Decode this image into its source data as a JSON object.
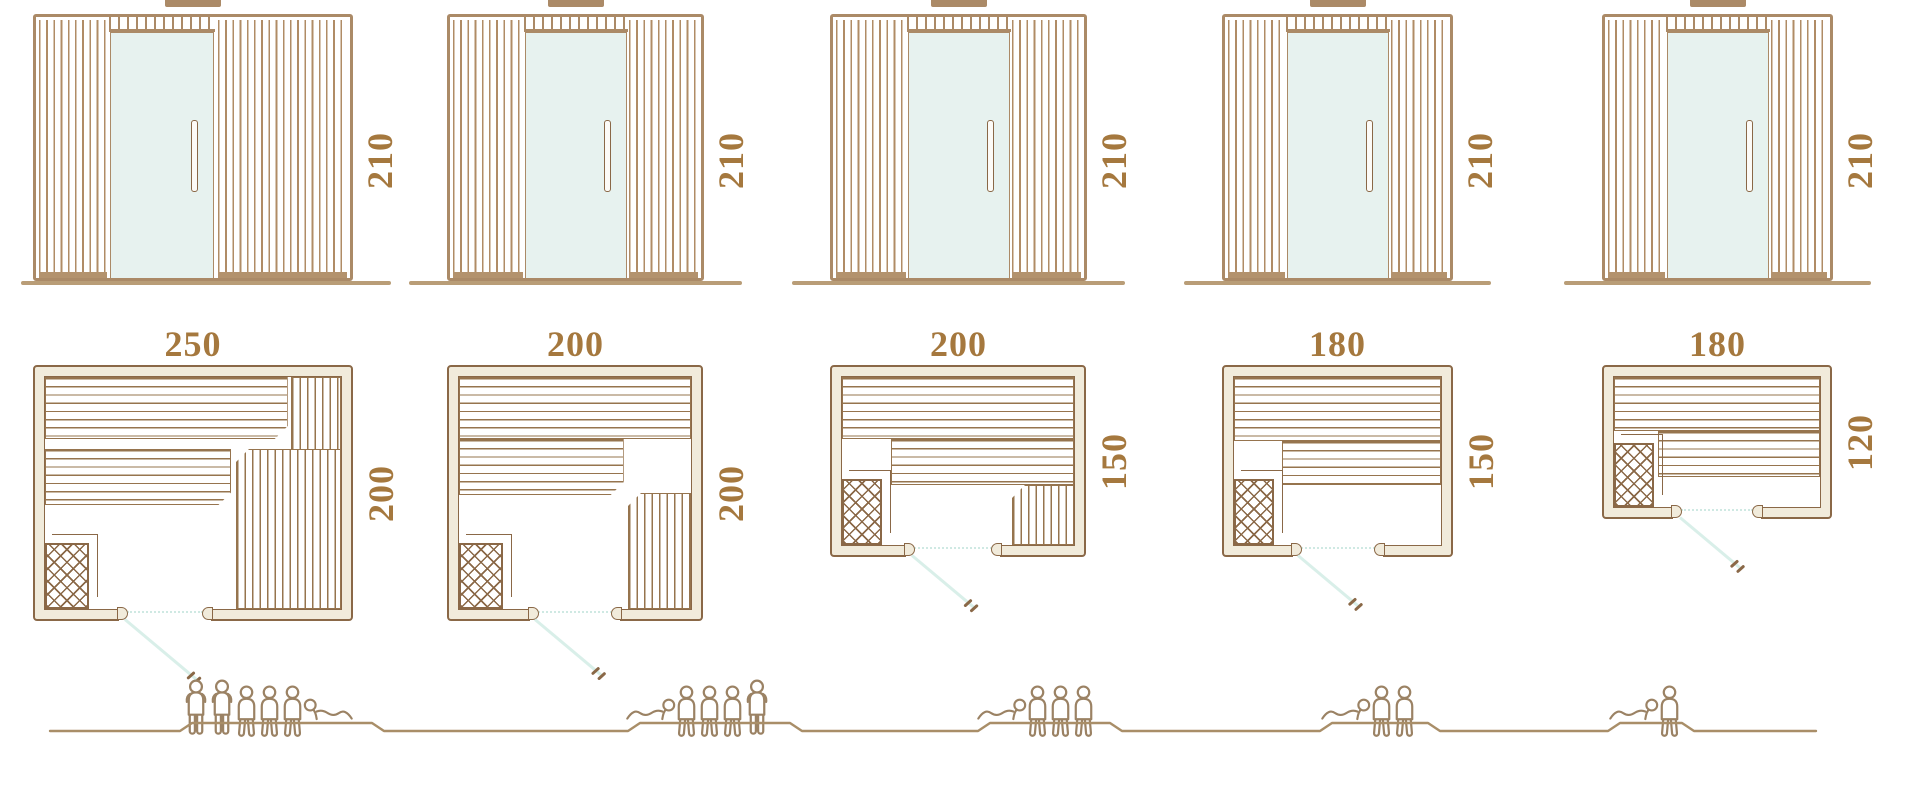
{
  "diagram": {
    "type": "sauna-size-comparison",
    "views": [
      "front-elevation",
      "floor-plan",
      "capacity"
    ]
  },
  "theme": {
    "outline": "#8a6847",
    "wood_light": "#b08c66",
    "frame": "#ab8a67",
    "wall_fill": "#f1ebdb",
    "glass": "#e7f2ef",
    "label": "#a5783e",
    "swing_line": "#d9efe9",
    "figure": "#9b8264",
    "ground": "#a98e68"
  },
  "columns": [
    {
      "elevation": {
        "height": "210"
      },
      "plan": {
        "width": "250",
        "depth": "200"
      },
      "capacity": {
        "count": 6,
        "poses": [
          "standing",
          "standing",
          "sitting",
          "sitting",
          "sitting",
          "lying"
        ]
      }
    },
    {
      "elevation": {
        "height": "210"
      },
      "plan": {
        "width": "200",
        "depth": "200"
      },
      "capacity": {
        "count": 5,
        "poses": [
          "lying",
          "sitting",
          "sitting",
          "sitting",
          "standing"
        ]
      }
    },
    {
      "elevation": {
        "height": "210"
      },
      "plan": {
        "width": "200",
        "depth": "150"
      },
      "capacity": {
        "count": 4,
        "poses": [
          "lying",
          "sitting",
          "sitting",
          "sitting"
        ]
      }
    },
    {
      "elevation": {
        "height": "210"
      },
      "plan": {
        "width": "180",
        "depth": "150"
      },
      "capacity": {
        "count": 3,
        "poses": [
          "lying",
          "sitting",
          "sitting"
        ]
      }
    },
    {
      "elevation": {
        "height": "210"
      },
      "plan": {
        "width": "180",
        "depth": "120"
      },
      "capacity": {
        "count": 2,
        "poses": [
          "lying",
          "sitting"
        ]
      }
    }
  ]
}
